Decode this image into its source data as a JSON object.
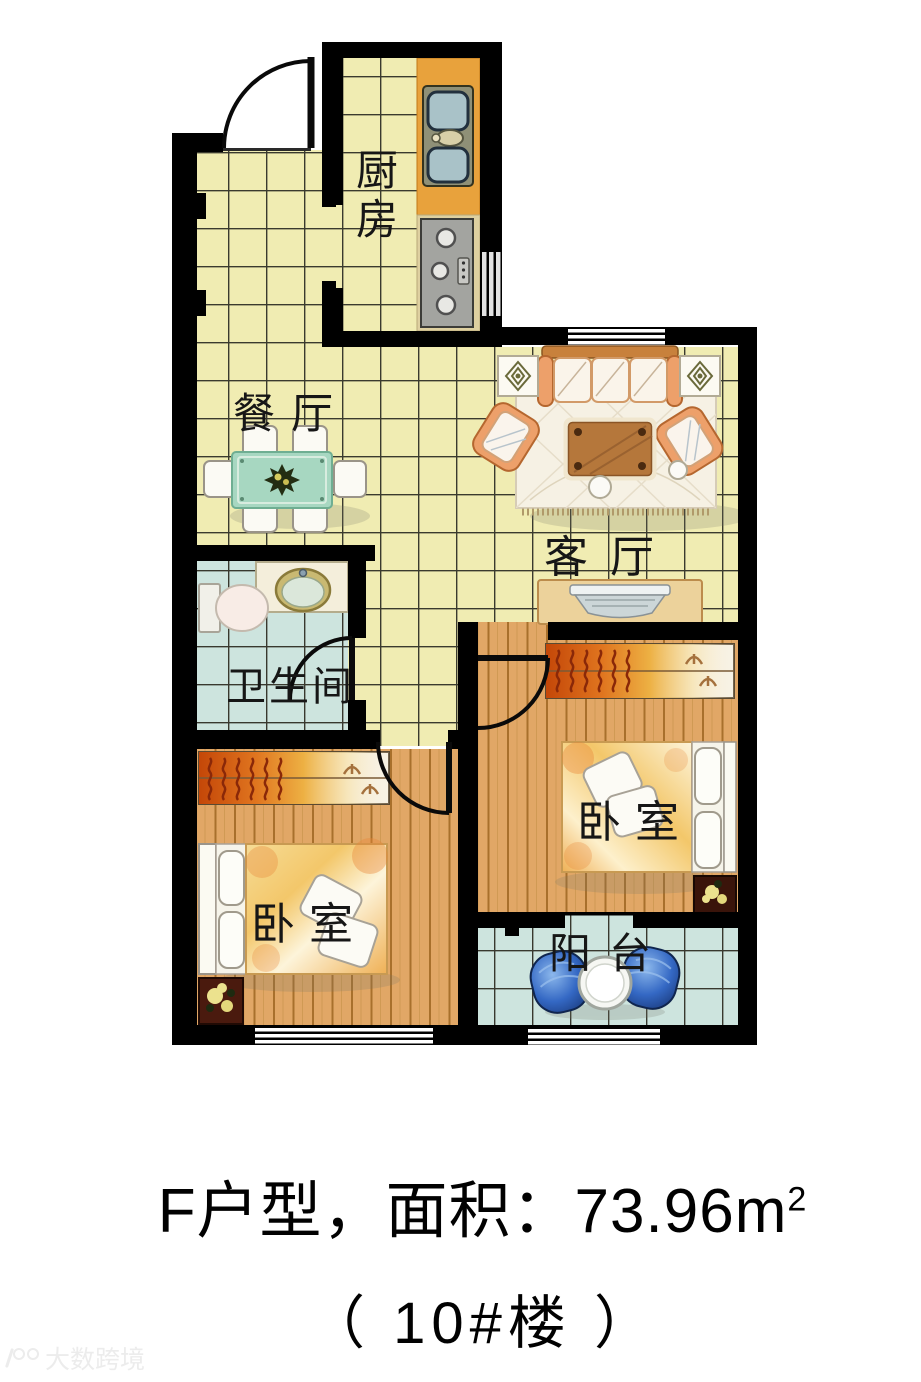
{
  "floorplan": {
    "rooms": {
      "kitchen": "厨房",
      "dining": "餐厅",
      "living": "客厅",
      "bathroom": "卫生间",
      "bedroom_right": "卧室",
      "bedroom_left": "卧室",
      "balcony": "阳台"
    },
    "colors": {
      "wall": "#000000",
      "tile_floor": "#f0ecb2",
      "wet_floor": "#cde4de",
      "wood_floor": "#e1a766",
      "counter_orange": "#e8a23c",
      "dining_table_green": "#a7d7c1",
      "sofa_orange": "#e8945a",
      "balcony_chair_blue": "#3468c4"
    }
  },
  "caption": {
    "area_text": "F户型，面积：73.96m",
    "area_sup": "2",
    "building_text": "（ 10#楼 ）"
  },
  "watermark": {
    "text": "大数跨境"
  }
}
